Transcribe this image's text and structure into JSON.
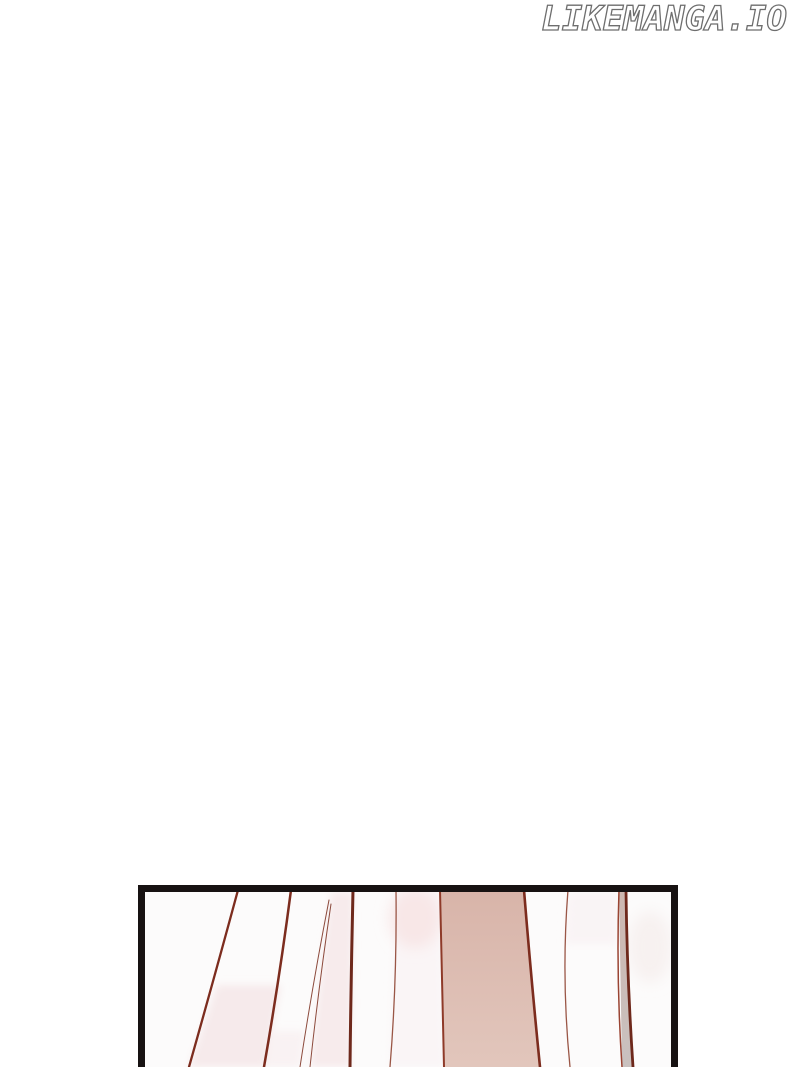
{
  "page": {
    "background": "#ffffff"
  },
  "watermark": {
    "text": "LIKEMANGA.IO",
    "fill": "#ffffff",
    "outline": "#6e6e6e"
  },
  "panel": {
    "border_color": "#171212",
    "background": "#fcfbfb",
    "colors": {
      "fold_line_dark": "#7c2c1e",
      "fold_line_deep": "#6e281b",
      "fold_line_thin": "#8c4a3c",
      "fold_line_soft": "#9a5646",
      "band_edge_left": "#8e3a29",
      "band_edge_right": "#7c2c1e",
      "band_top": "#d8b4a9",
      "band_bottom": "#e2c6bc",
      "wedge_line_left": "#9a4433",
      "wedge_line_right": "#6e281b",
      "wedge_top": "#cdb7b0",
      "wedge_bottom": "#c9c1bf",
      "wash_pink": "#f4e2e4",
      "wash_faint": "#f8eef0",
      "wash_strip": "#f8f1f2",
      "blush": "#f7e2e1",
      "corner_tint": "#f3e9e7"
    }
  }
}
